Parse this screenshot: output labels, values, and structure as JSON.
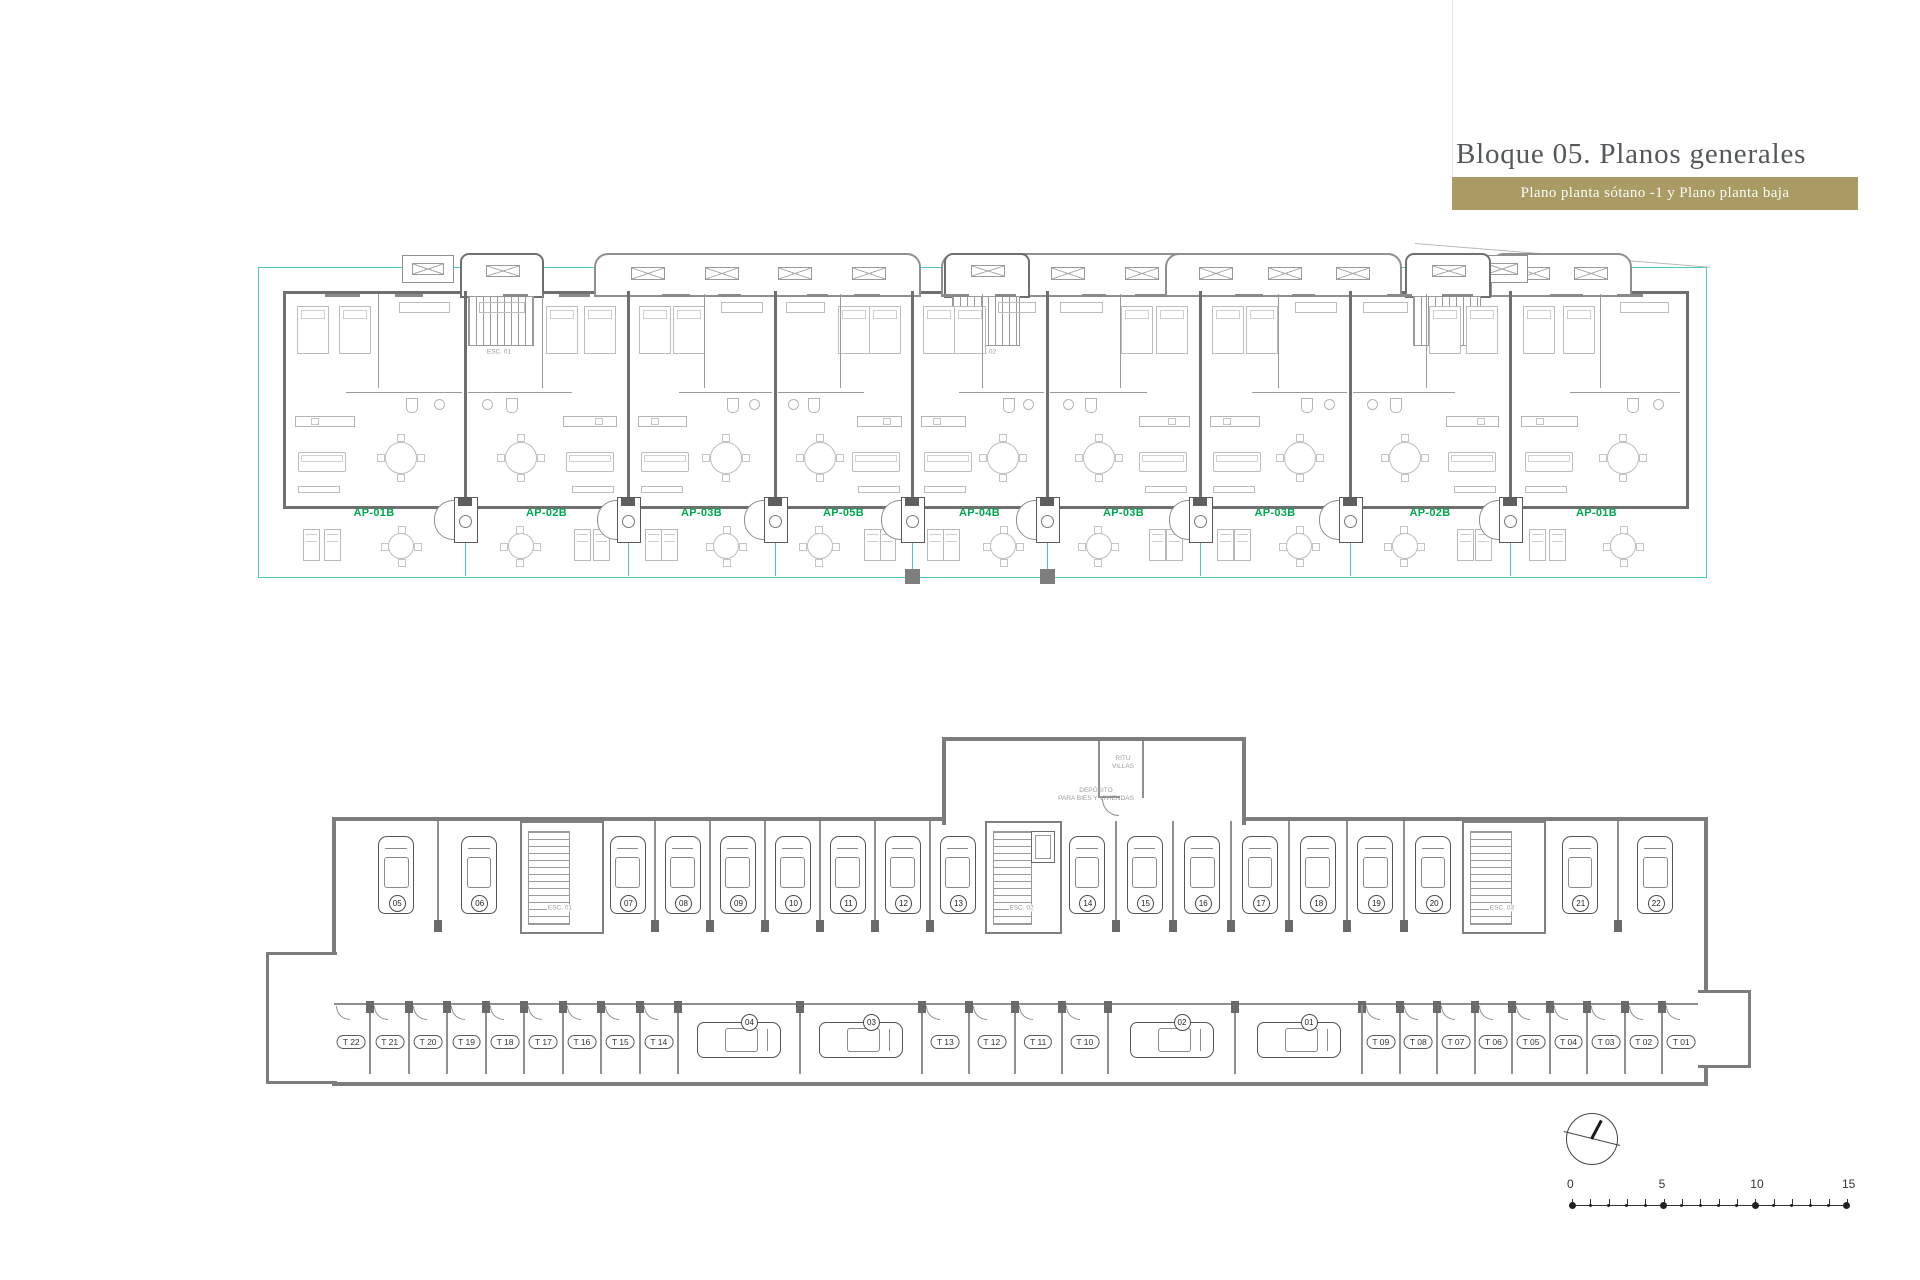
{
  "header": {
    "title": "Bloque 05. Planos generales",
    "subtitle": "Plano planta sótano -1 y Plano planta baja"
  },
  "ground_floor": {
    "apartments": [
      {
        "label": "AP-01B"
      },
      {
        "label": "AP-02B"
      },
      {
        "label": "AP-03B"
      },
      {
        "label": "AP-05B"
      },
      {
        "label": "AP-04B"
      },
      {
        "label": "AP-03B"
      },
      {
        "label": "AP-03B"
      },
      {
        "label": "AP-02B"
      },
      {
        "label": "AP-01B"
      }
    ],
    "closet_label": "A.R",
    "stair_labels": [
      "ESC. 01",
      "ESC. 02",
      "ESC. 03"
    ]
  },
  "basement": {
    "rooms": {
      "deposit_line1": "DEPÓSITO",
      "deposit_line2": "PARA BIES Y VIVIENDAS",
      "ritu_line1": "RITU",
      "ritu_line2": "VILLAS"
    },
    "stair_labels": [
      "ESC. 01",
      "ESC. 02",
      "ESC. 03"
    ],
    "parking_upper": [
      "05",
      "06",
      "07",
      "08",
      "09",
      "10",
      "11",
      "12",
      "13",
      "14",
      "15",
      "16",
      "17",
      "18",
      "19",
      "20",
      "21",
      "22"
    ],
    "parking_lower": [
      "04",
      "03",
      "02",
      "01"
    ],
    "storage_rooms": [
      "T 22",
      "T 21",
      "T 20",
      "T 19",
      "T 18",
      "T 17",
      "T 16",
      "T 15",
      "T 14",
      "T 13",
      "T 12",
      "T 11",
      "T 10",
      "T 09",
      "T 08",
      "T 07",
      "T 06",
      "T 05",
      "T 04",
      "T 03",
      "T 02",
      "T 01"
    ]
  },
  "scale_bar": {
    "tick_labels": [
      "0",
      "5",
      "10",
      "15"
    ]
  },
  "colors": {
    "accent_gold": "#a99b63",
    "apartment_label_green": "#00a84e",
    "boundary_teal": "#4cc7c3",
    "wall_gray": "#6f6f6f"
  }
}
